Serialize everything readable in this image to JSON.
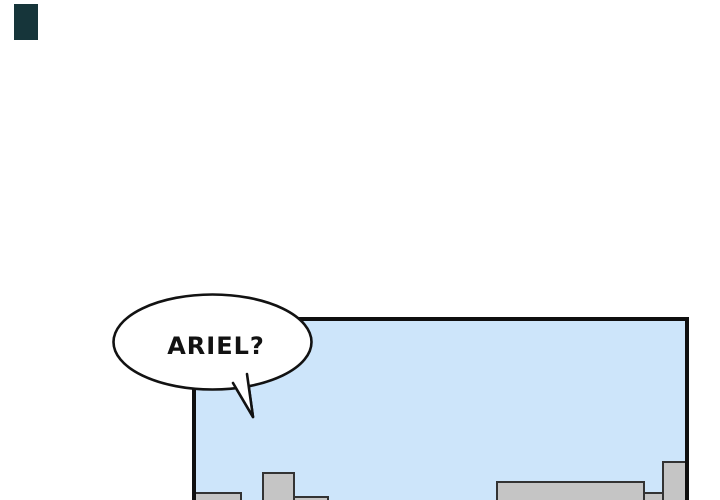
{
  "speech_bubble": {
    "text": "ARIEL?"
  },
  "colors": {
    "page_bg": "#ffffff",
    "fragment": "#16353a",
    "panel_border": "#0f0f0f",
    "sky": "#cde5fa",
    "building_fill": "#c5c5c5",
    "building_outline": "#333333",
    "bubble_fill": "#ffffff",
    "bubble_stroke": "#121212",
    "text": "#121212"
  }
}
